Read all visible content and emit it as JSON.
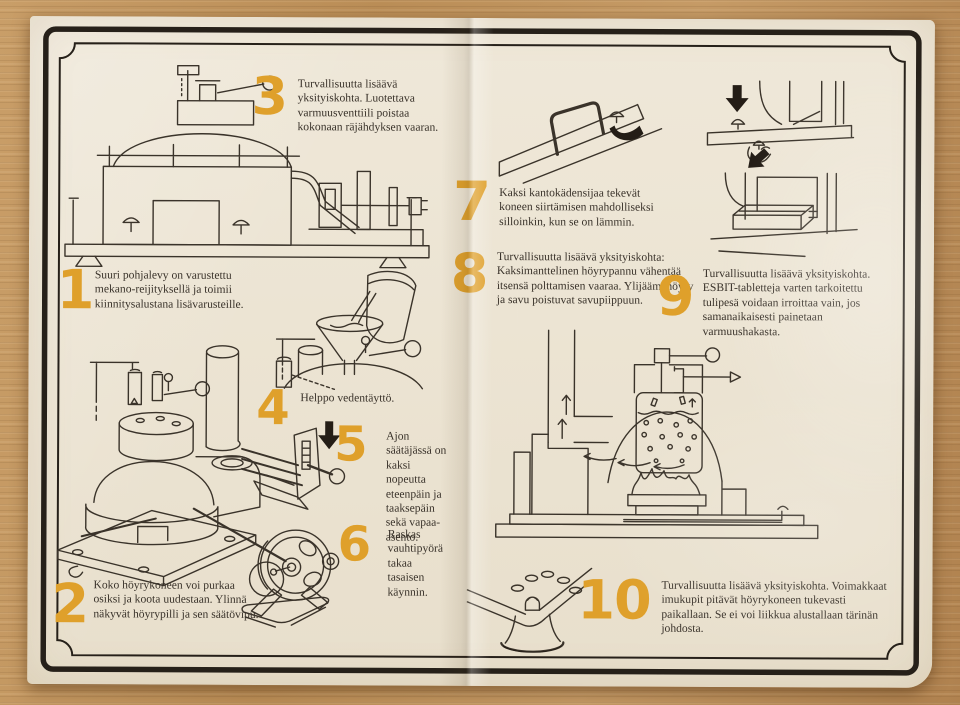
{
  "colors": {
    "number_accent": "#dfa02b",
    "paper": "#ece4d3",
    "ink": "#3a332a",
    "wood": "#bb8e57"
  },
  "steps": [
    {
      "number": "1",
      "text": "Suuri pohjalevy on varustettu mekano-reijityksellä ja toimii kiinnitysalustana lisävarusteille."
    },
    {
      "number": "2",
      "text": "Koko höyrykoneen voi purkaa osiksi ja koota uudestaan. Ylinnä näkyvät höyrypilli ja sen säätövipu."
    },
    {
      "number": "3",
      "text": "Turvallisuutta lisäävä yksityiskohta. Luotettava varmuusventtiili poistaa kokonaan räjähdyksen vaaran."
    },
    {
      "number": "4",
      "text": "Helppo vedentäyttö."
    },
    {
      "number": "5",
      "text": "Ajon säätäjässä on kaksi nopeutta eteenpäin ja taaksepäin sekä vapaa-asento."
    },
    {
      "number": "6",
      "text": "Raskas vauhtipyörä takaa tasaisen käynnin."
    },
    {
      "number": "7",
      "text": "Kaksi kantokädensijaa tekevät koneen siirtämisen mahdolliseksi silloinkin, kun se on lämmin."
    },
    {
      "number": "8",
      "text": "Turvallisuutta lisäävä yksityiskohta: Kaksimanttelinen höyrypannu vähentää itsensä polttamisen vaaraa. Ylijäämähöyry ja savu poistuvat savupiippuun."
    },
    {
      "number": "9",
      "text": "Turvallisuutta lisäävä yksityiskohta. ESBIT-tabletteja varten tarkoitettu tulipesä voidaan irroittaa vain, jos samanaikaisesti painetaan varmuushakasta."
    },
    {
      "number": "10",
      "text": "Turvallisuutta lisäävä yksityiskohta. Voimakkaat imukupit pitävät höyrykoneen tukevasti paikallaan. Se ei voi liikkua alustallaan tärinän johdosta."
    }
  ]
}
